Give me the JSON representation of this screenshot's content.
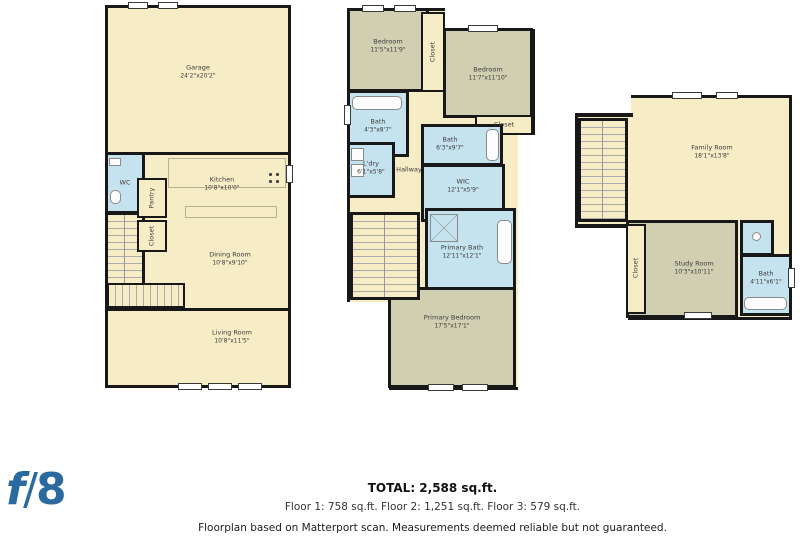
{
  "palette": {
    "floor_cream": "#f6edc6",
    "room_olive": "#d0cfb2",
    "bath_blue": "#c5e3ee",
    "wall_black": "#181818",
    "logo_blue": "#2b6a9e"
  },
  "logo": {
    "f": "f",
    "slash": "/",
    "eight": "8"
  },
  "floor1": {
    "garage": {
      "name": "Garage",
      "dims": "24'2\"x20'2\""
    },
    "wc": {
      "name": "WC"
    },
    "kitchen": {
      "name": "Kitchen",
      "dims": "10'8\"x10'0\""
    },
    "pantry": {
      "name": "Pantry"
    },
    "closet": {
      "name": "Closet"
    },
    "dining": {
      "name": "Dining Room",
      "dims": "10'8\"x9'10\""
    },
    "living": {
      "name": "Living Room",
      "dims": "10'8\"x11'5\""
    }
  },
  "floor2": {
    "bedroom1": {
      "name": "Bedroom",
      "dims": "11'5\"x11'9\""
    },
    "closet1": {
      "name": "Closet"
    },
    "bedroom2": {
      "name": "Bedroom",
      "dims": "11'7\"x11'10\""
    },
    "closet2": {
      "name": "Closet"
    },
    "bath1": {
      "name": "Bath",
      "dims": "4'3\"x8'7\""
    },
    "bath2": {
      "name": "Bath",
      "dims": "6'3\"x9'7\""
    },
    "ldry": {
      "name": "L'dry",
      "dims": "6'1\"x5'8\""
    },
    "hallway": {
      "name": "Hallway"
    },
    "wic": {
      "name": "WIC",
      "dims": "12'1\"x5'9\""
    },
    "primary_bath": {
      "name": "Primary Bath",
      "dims": "12'11\"x12'1\""
    },
    "primary_bedroom": {
      "name": "Primary Bedroom",
      "dims": "17'5\"x17'1\""
    }
  },
  "floor3": {
    "family": {
      "name": "Family Room",
      "dims": "18'1\"x13'8\""
    },
    "closet": {
      "name": "Closet"
    },
    "study": {
      "name": "Study Room",
      "dims": "10'3\"x10'11\""
    },
    "bath": {
      "name": "Bath",
      "dims": "4'11\"x6'1\""
    }
  },
  "footer": {
    "total": "TOTAL: 2,588 sq.ft.",
    "floors": "Floor 1: 758 sq.ft.  Floor 2: 1,251 sq.ft. Floor 3: 579 sq.ft.",
    "disclaimer": "Floorplan based on Matterport scan. Measurements deemed reliable but not guaranteed."
  }
}
